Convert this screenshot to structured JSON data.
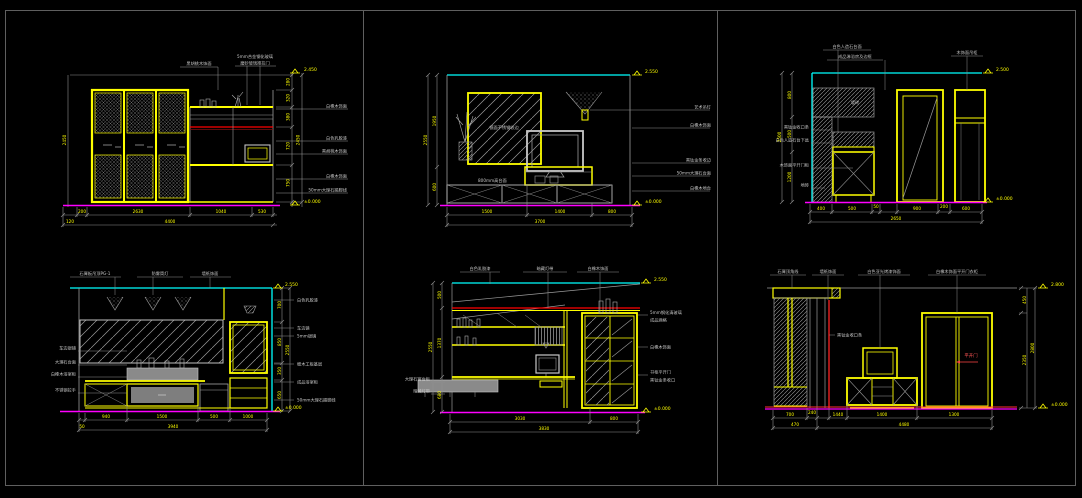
{
  "canvas": {
    "background": "#000000",
    "frame_color": "#5f5f5f"
  },
  "colors": {
    "furniture_yellow": "#ffff00",
    "wall_cyan": "#00ffff",
    "floor_magenta": "#ff00ff",
    "accent_red": "#ff2222",
    "dim_gray": "#9b9b9b"
  },
  "panels": {
    "p1": {
      "top_labels": [
        "黑胡桃木饰面",
        "5mm合金钢化玻璃",
        "磨砂玻璃推拉门"
      ],
      "right_labels": [
        "白橡木饰面",
        "白色乳胶漆",
        "黑胡桃木饰面",
        "白橡木饰面",
        "50mm大理石踢脚线"
      ],
      "right_dims": [
        "280",
        "320",
        "380",
        "720",
        "750"
      ],
      "right_total": "2450",
      "bottom_dims": [
        "200",
        "2630",
        "1040",
        "530"
      ],
      "bottom_sub": "120",
      "bottom_total": "4400",
      "level_top": "2.450",
      "level_bottom": "±0.000"
    },
    "p2": {
      "mirror_note": "镜面不锈钢收边",
      "cabinet_note": "800mm高台面",
      "right_labels": [
        "艺术吊灯",
        "白橡木饰面",
        "黑钛金条收边",
        "50mm大理石台面",
        "白橡木地台"
      ],
      "left_dims": [
        "1950",
        "600"
      ],
      "left_total": "2550",
      "bottom_dims": [
        "1500",
        "1400",
        "800"
      ],
      "bottom_total": "3700",
      "level_top": "2.550",
      "level_bottom": "±0.000"
    },
    "p3": {
      "top_labels": [
        "白色人造石台面",
        "成品淋浴房及边框",
        "木饰面吊柜"
      ],
      "left_labels": [
        "黑钛金收口条",
        "白色人造石台下盆",
        "木饰面平开门柜",
        "地砖"
      ],
      "wall_note": "墙砖",
      "left_dims": [
        "800",
        "500",
        "1200"
      ],
      "left_total": "2500",
      "bottom_dims": [
        "400",
        "500",
        "50",
        "900",
        "200",
        "600"
      ],
      "bottom_total": "2650",
      "level_top": "2.500",
      "level_bottom": "±0.000"
    },
    "p4": {
      "top_labels": [
        "石膏板吊顶PG-1",
        "防雾筒灯",
        "墙纸饰面"
      ],
      "left_labels": [
        "车边银镜",
        "大理石台面",
        "白橡木浴室柜",
        "不锈钢拉手"
      ],
      "right_labels": [
        "白色乳胶漆",
        "车边镜",
        "5mm银镜",
        "细木工板基层",
        "成品浴室柜",
        "50mm大理石踢脚线"
      ],
      "right_dims": [
        "700",
        "850",
        "350",
        "650"
      ],
      "right_total": "2550",
      "bottom_dims": [
        "940",
        "1500",
        "500",
        "1000"
      ],
      "bottom_sub": "50",
      "bottom_total": "3940",
      "level_top": "2.550",
      "level_bottom": "±0.000"
    },
    "p5": {
      "top_labels": [
        "白色乳胶漆",
        "暗藏灯带",
        "白橡木饰面"
      ],
      "left_labels": [
        "大理石窗台板",
        "暗藏灯带"
      ],
      "right_labels": [
        "5mm钢化清玻璃",
        "成品酒格",
        "白橡木饰面",
        "书柜平开门",
        "黑钛金条收口"
      ],
      "left_dims": [
        "500",
        "1370",
        "680"
      ],
      "left_total": "2550",
      "bottom_dims": [
        "3030",
        "800"
      ],
      "bottom_total": "3830",
      "level_top": "2.550",
      "level_bottom": "±0.000"
    },
    "p6": {
      "top_labels": [
        "石膏顶角线",
        "墙纸饰面",
        "白色亚光烤漆饰面",
        "白橡木饰面平开门衣柜"
      ],
      "mid_label": "黑钛金收口条",
      "door_label": "平开门",
      "right_dims": [
        "450",
        "2350"
      ],
      "right_total": "2800",
      "bottom_dims": [
        "700",
        "240",
        "1440",
        "1400",
        "1300"
      ],
      "bottom_row2": [
        "470",
        "4480"
      ],
      "level_top": "2.800",
      "level_bottom": "±0.000"
    }
  }
}
